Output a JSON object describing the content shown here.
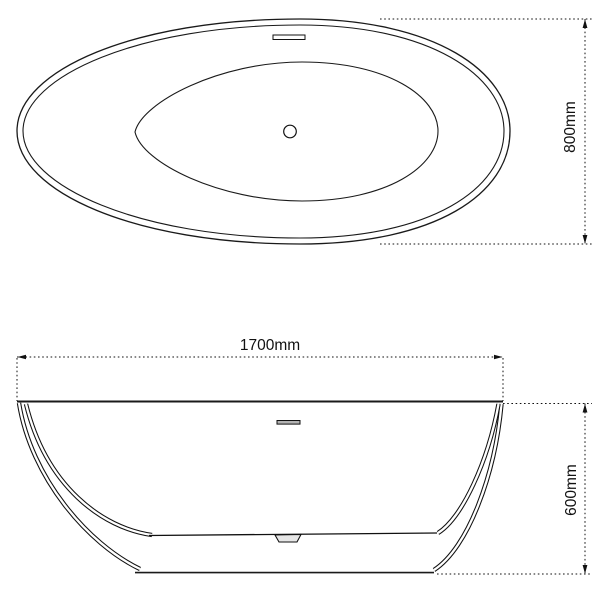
{
  "drawing": {
    "type": "bathtub-technical-drawing",
    "views": {
      "top_view": {
        "title": "plan view of oval freestanding bathtub",
        "width_dimension": "800mm",
        "features": [
          "rim",
          "basin",
          "drain",
          "overflow-slot"
        ]
      },
      "side_view": {
        "title": "side elevation of bathtub",
        "length_dimension": "1700mm",
        "height_dimension": "600mm",
        "features": [
          "rim",
          "shell",
          "inner-basin",
          "drain-recess",
          "overflow-slot"
        ]
      }
    },
    "colors": {
      "background": "#ffffff",
      "line": "#1a1a1a",
      "dimension_line": "#111111",
      "text": "#111111",
      "overflow_fill": "#b3b3b3",
      "drain_recess_fill": "#e6e6e6"
    }
  }
}
